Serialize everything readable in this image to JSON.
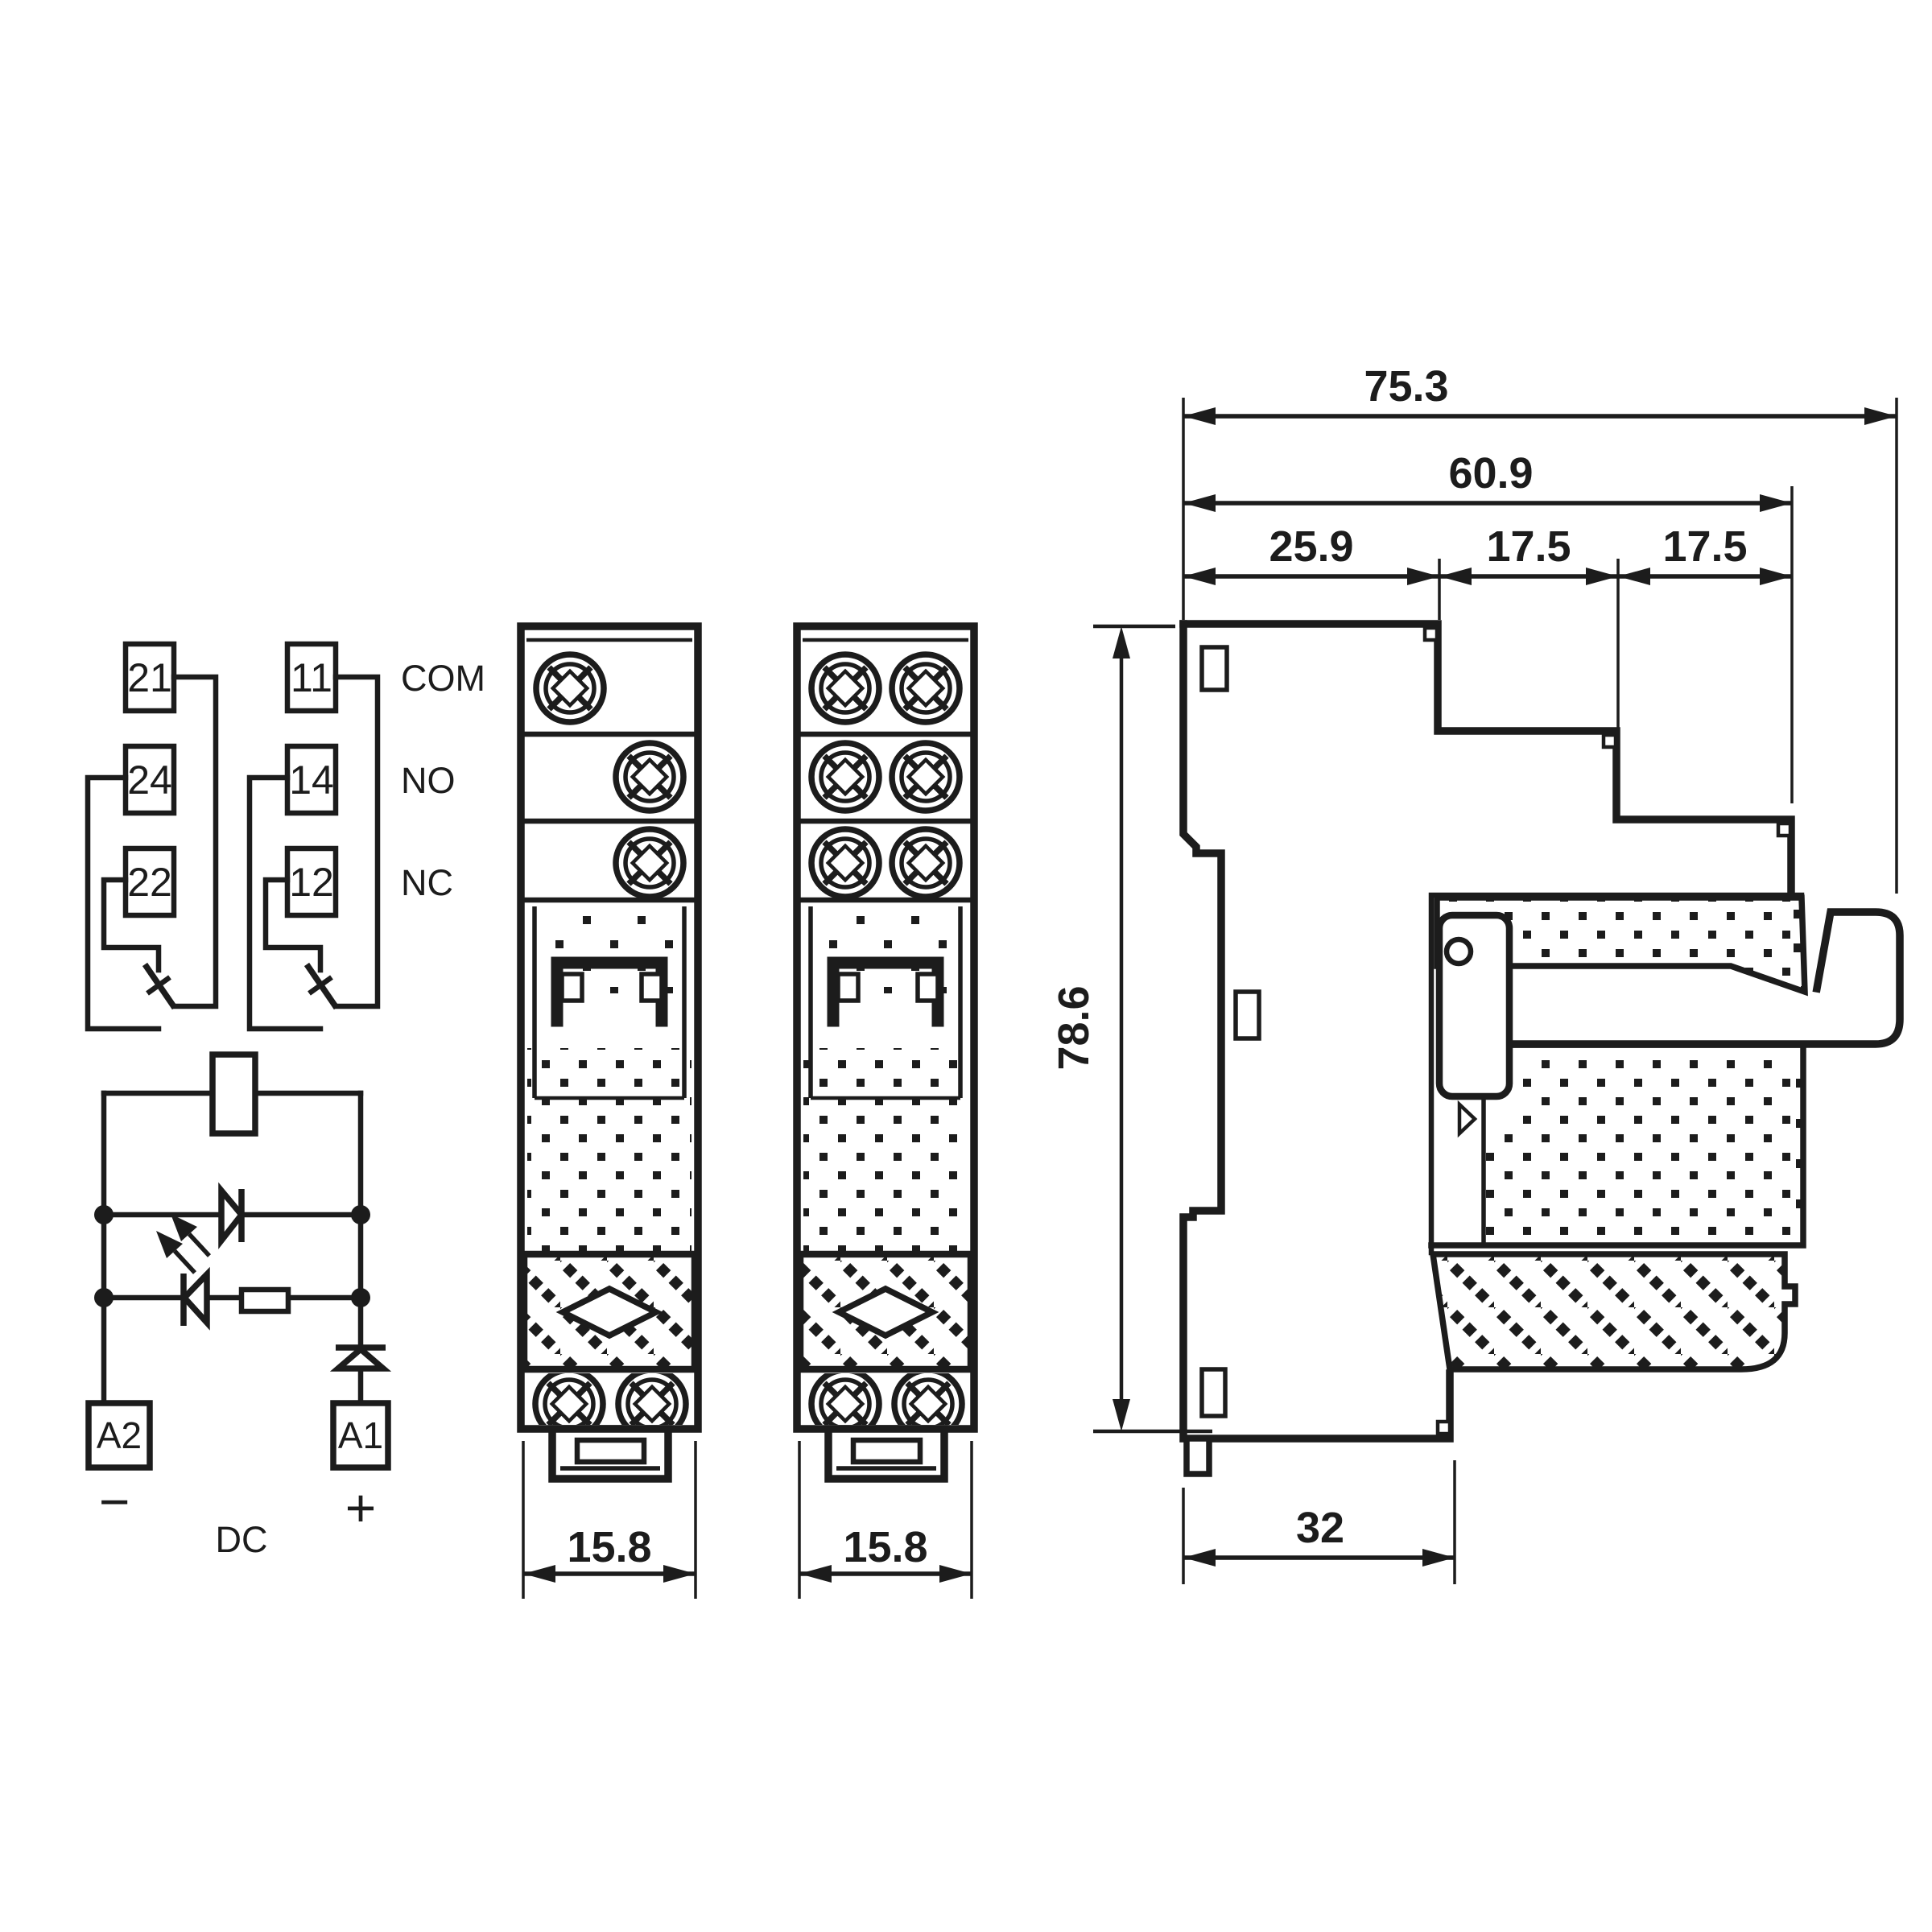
{
  "colors": {
    "ink": "#1c1c1c",
    "background": "#ffffff"
  },
  "contact_diagram": {
    "pole2": {
      "com_terminal": "21",
      "no_terminal": "24",
      "nc_terminal": "22"
    },
    "pole1": {
      "com_terminal": "11",
      "no_terminal": "14",
      "nc_terminal": "12"
    },
    "row_labels": {
      "com": "COM",
      "no": "NO",
      "nc": "NC"
    }
  },
  "coil_circuit": {
    "terminal_negative": "A2",
    "terminal_positive": "A1",
    "negative_sign": "−",
    "positive_sign": "+",
    "supply_label": "DC"
  },
  "front_views": {
    "module1": {
      "width_mm": "15.8"
    },
    "module2": {
      "width_mm": "15.8"
    }
  },
  "side_view": {
    "overall_depth_mm": "75.3",
    "upper_depth_mm": "60.9",
    "segment1_mm": "25.9",
    "segment2_mm": "17.5",
    "segment3_mm": "17.5",
    "height_mm": "78.6",
    "base_depth_mm": "32"
  }
}
